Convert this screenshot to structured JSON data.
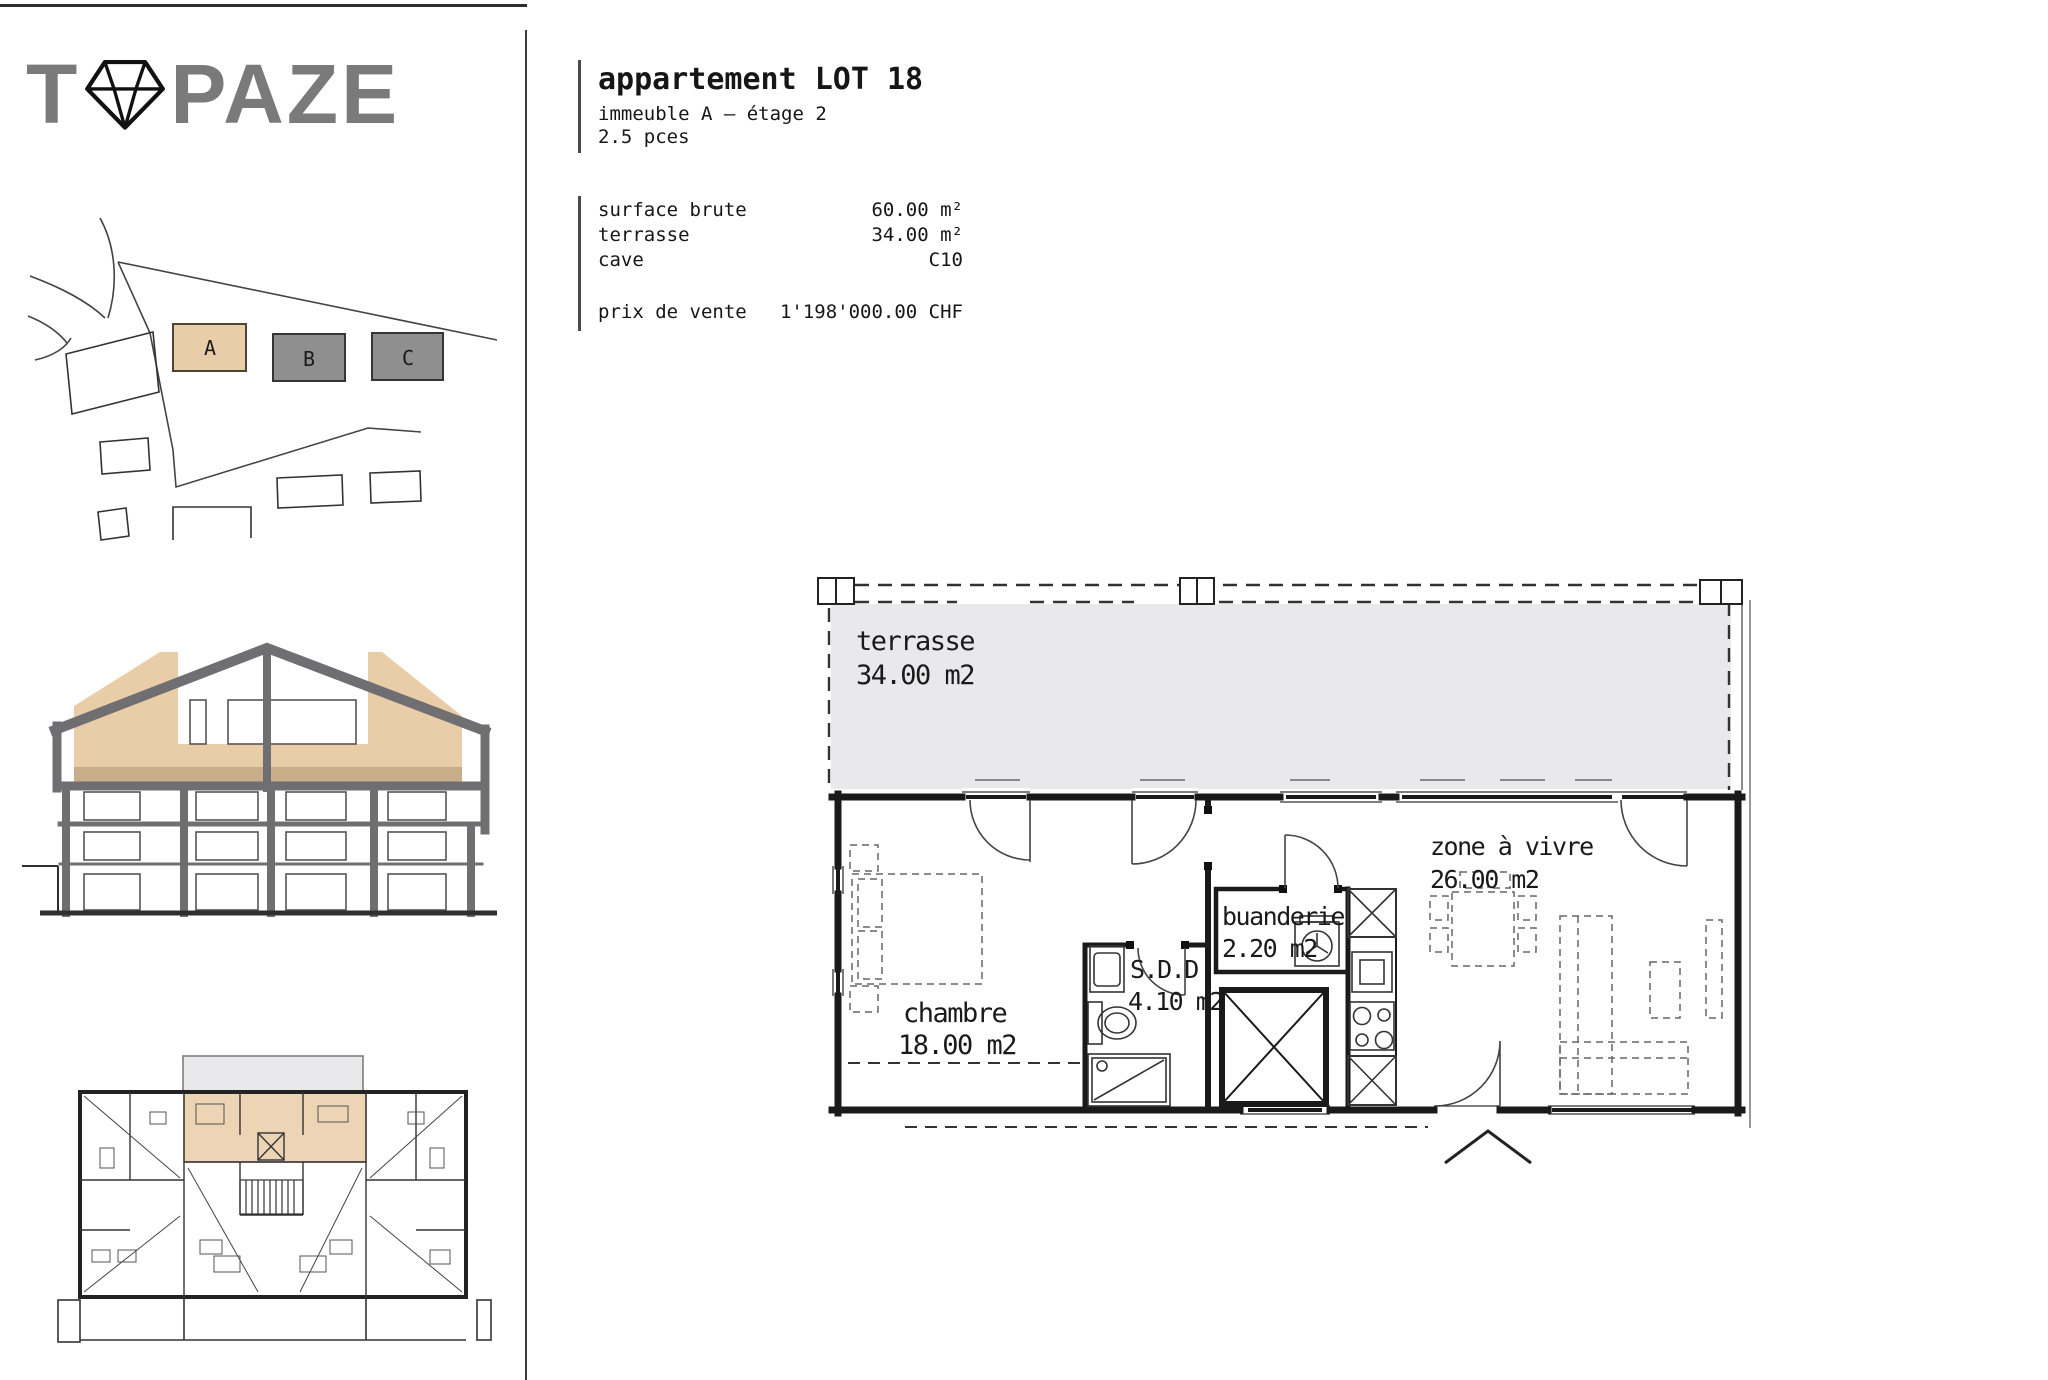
{
  "brand": {
    "logo_pre": "T",
    "logo_post": "PAZE",
    "diamond_icon": "diamond-icon"
  },
  "header": {
    "title": "appartement LOT 18",
    "line2": "immeuble A – étage 2",
    "line3": "2.5 pces"
  },
  "details": {
    "rows": [
      {
        "label": "surface brute",
        "value": "60.00 m²"
      },
      {
        "label": "terrasse",
        "value": "34.00 m²"
      },
      {
        "label": "cave",
        "value": "C10"
      }
    ],
    "price": {
      "label": "prix de vente",
      "value": "1'198'000.00 CHF"
    }
  },
  "site_plan": {
    "building_a": "A",
    "building_b": "B",
    "building_c": "C"
  },
  "floor_plan": {
    "terrace_name": "terrasse",
    "terrace_area": "34.00 m2",
    "bedroom_name": "chambre",
    "bedroom_area": "18.00 m2",
    "bathroom_name": "S.D.D",
    "bathroom_area": "4.10 m2",
    "laundry_name": "buanderie",
    "laundry_area": "2.20 m2",
    "living_name": "zone à vivre",
    "living_area": "26.00 m2"
  },
  "colors": {
    "highlight_beige": "#e9cda8",
    "highlight_beige_dark": "#c9ad8a",
    "building_gray": "#8f8f8f",
    "terrace_gray": "#e9e9ec",
    "structure_gray": "#6f6f72",
    "line_dark": "#1a1a1a"
  }
}
